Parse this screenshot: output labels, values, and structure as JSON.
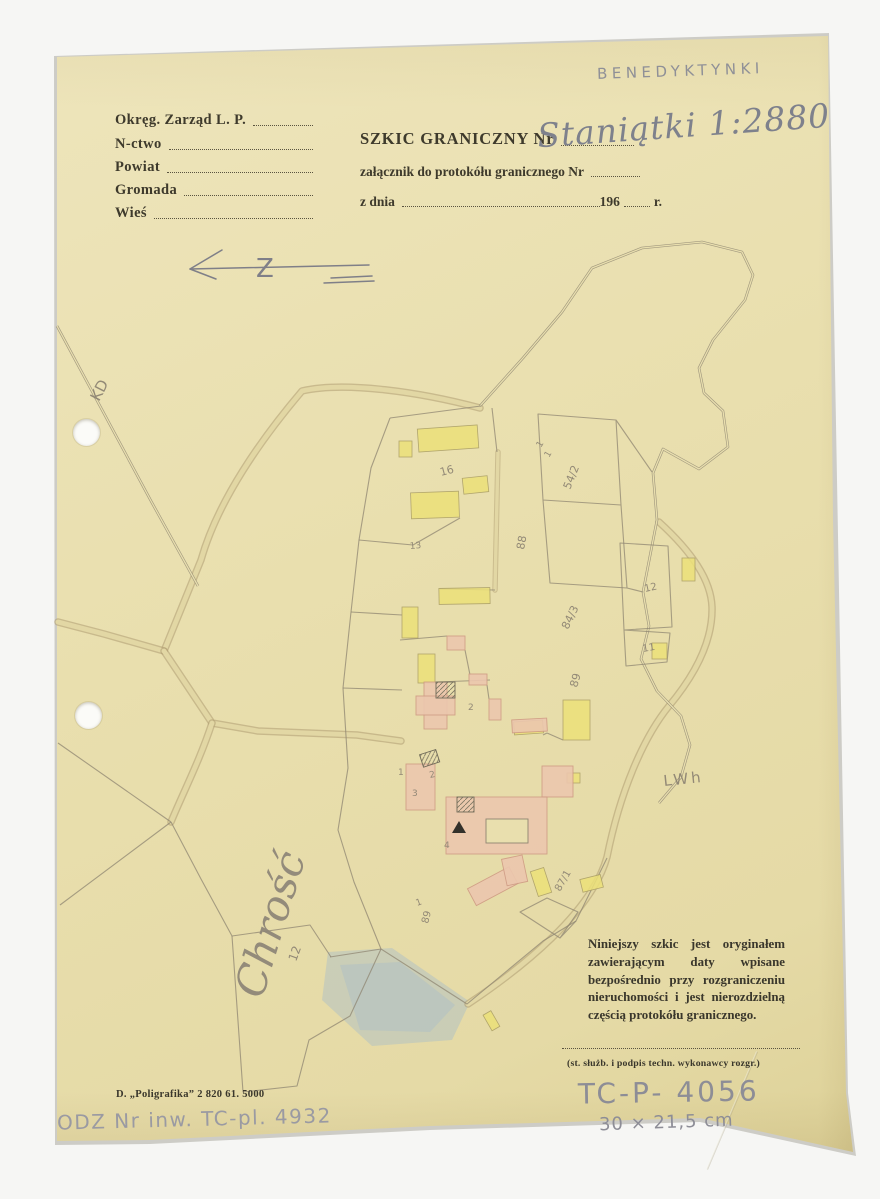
{
  "colors": {
    "bg": "#f6f6f4",
    "paper": "#e9dfae",
    "ink": "#3e3a2c",
    "pencil-hand": "#8d8d96",
    "pencil-map": "#8a8171"
  },
  "annotations": {
    "archive_stamp": "BENEDYKTYNKI",
    "catalog_number": "TC-P- 4056",
    "dimensions": "30 × 21,5 cm",
    "inventory_number": "ODZ Nr inw. TC-pl. 4932"
  },
  "form": {
    "rows": [
      {
        "label": "Okręg. Zarząd L. P."
      },
      {
        "label": "N-ctwo"
      },
      {
        "label": "Powiat"
      },
      {
        "label": "Gromada"
      },
      {
        "label": "Wieś"
      }
    ]
  },
  "title": {
    "heading": "SZKIC GRANICZNY Nr",
    "handwritten_number": "Staniątki 1:2880",
    "attachment_line": "załącznik do protokółu granicznego Nr",
    "date_prefix": "z dnia",
    "date_year": "196",
    "date_suffix": "r."
  },
  "map": {
    "north_letter": "Z",
    "labels": [
      {
        "text": "Chrość",
        "x": 262,
        "y": 1000,
        "rot": -73,
        "size": 42,
        "cls": "script"
      },
      {
        "text": "12",
        "x": 296,
        "y": 962,
        "rot": -70,
        "size": 12
      },
      {
        "text": "KD",
        "x": 99,
        "y": 402,
        "rot": -63,
        "size": 15
      },
      {
        "text": "LWh",
        "x": 664,
        "y": 786,
        "rot": -6,
        "size": 15,
        "cls": "wide"
      },
      {
        "text": "16",
        "x": 441,
        "y": 476,
        "rot": -15,
        "size": 11
      },
      {
        "text": "13",
        "x": 410,
        "y": 549,
        "rot": -5,
        "size": 9
      },
      {
        "text": "54/2",
        "x": 570,
        "y": 490,
        "rot": -68,
        "size": 11
      },
      {
        "text": "88",
        "x": 524,
        "y": 550,
        "rot": -80,
        "size": 11
      },
      {
        "text": "84/3",
        "x": 568,
        "y": 630,
        "rot": -64,
        "size": 11
      },
      {
        "text": "89",
        "x": 577,
        "y": 688,
        "rot": -74,
        "size": 11
      },
      {
        "text": "12",
        "x": 645,
        "y": 592,
        "rot": -12,
        "size": 10
      },
      {
        "text": "11",
        "x": 643,
        "y": 652,
        "rot": -10,
        "size": 10
      },
      {
        "text": "87/1",
        "x": 560,
        "y": 892,
        "rot": -60,
        "size": 10
      },
      {
        "text": "89",
        "x": 428,
        "y": 924,
        "rot": -76,
        "size": 10
      },
      {
        "text": "1",
        "x": 417,
        "y": 906,
        "rot": -20,
        "size": 9
      },
      {
        "text": "1",
        "x": 398,
        "y": 775,
        "rot": 0,
        "size": 9
      },
      {
        "text": "2",
        "x": 430,
        "y": 778,
        "rot": -12,
        "size": 9
      },
      {
        "text": "3",
        "x": 412,
        "y": 796,
        "rot": 0,
        "size": 9
      },
      {
        "text": "4",
        "x": 444,
        "y": 848,
        "rot": 0,
        "size": 9
      },
      {
        "text": "2",
        "x": 468,
        "y": 710,
        "rot": 0,
        "size": 9
      },
      {
        "text": "1",
        "x": 541,
        "y": 448,
        "rot": -60,
        "size": 9
      },
      {
        "text": "1",
        "x": 549,
        "y": 458,
        "rot": -60,
        "size": 9
      }
    ]
  },
  "footer": {
    "note": "Niniejszy szkic jest oryginałem zawierającym daty wpisane bezpośrednio przy rozgraniczeniu nieruchomości i jest nierozdzielną częścią protokółu granicznego.",
    "signature_caption": "(st. służb. i podpis techn. wykonawcy rozgr.)",
    "printer_imprint": "D. „Poligrafika” 2 820 61. 5000"
  }
}
